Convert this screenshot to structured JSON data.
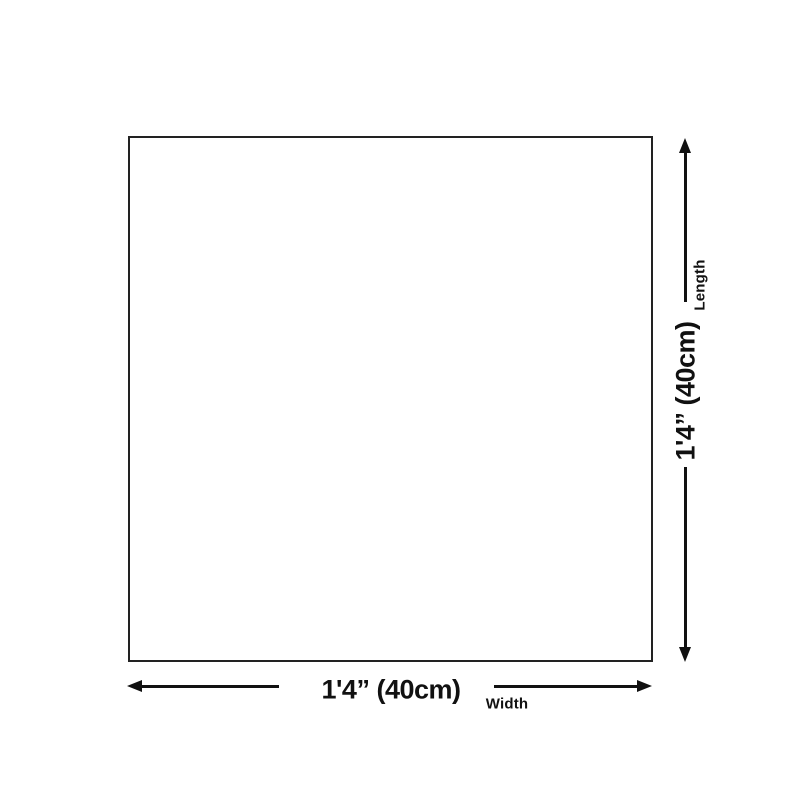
{
  "canvas": {
    "background": "#ffffff",
    "ink_color": "#111111",
    "outline_color": "#222222"
  },
  "dimensions": {
    "length": {
      "value": "1'4” (40cm)",
      "label": "Length"
    },
    "width": {
      "value": "1'4” (40cm)",
      "label": "Width"
    }
  }
}
